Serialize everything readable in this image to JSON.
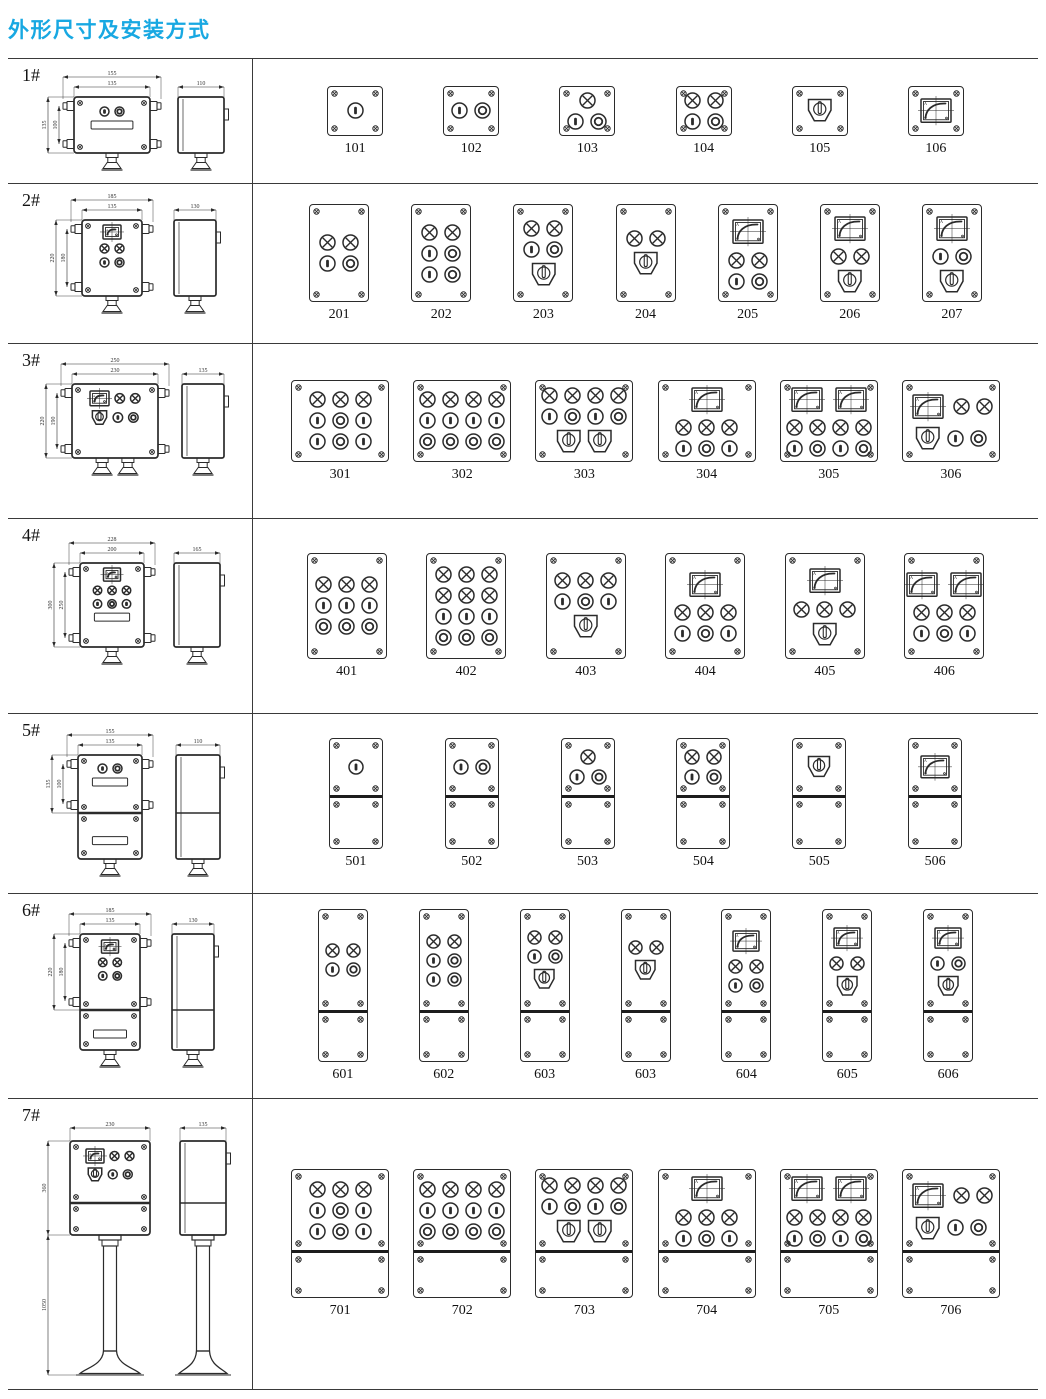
{
  "title": "外形尺寸及安装方式",
  "colors": {
    "accent": "#18a8e2",
    "line": "#2b2b2b"
  },
  "symbols": {
    "meter_label": "A"
  },
  "rows": [
    {
      "label": "1#",
      "dims": {
        "top_outer": "155",
        "top_inner": "135",
        "side_width": "110",
        "height_outer": "135",
        "height_inner": "100"
      },
      "variants": [
        {
          "id": "101",
          "rows": [
            [
              "btn1"
            ]
          ]
        },
        {
          "id": "102",
          "rows": [
            [
              "btn1",
              "btn2"
            ]
          ]
        },
        {
          "id": "103",
          "rows": [
            [
              "lamp"
            ],
            [
              "btn1",
              "btn2"
            ]
          ]
        },
        {
          "id": "104",
          "rows": [
            [
              "lamp",
              "lamp"
            ],
            [
              "btn1",
              "btn2"
            ]
          ]
        },
        {
          "id": "105",
          "rows": [
            [
              "rotary"
            ]
          ]
        },
        {
          "id": "106",
          "rows": [
            [
              "meter"
            ]
          ]
        }
      ]
    },
    {
      "label": "2#",
      "dims": {
        "top_outer": "185",
        "top_inner": "135",
        "side_width": "130",
        "height_outer": "220",
        "height_inner": "180"
      },
      "variants": [
        {
          "id": "201",
          "rows": [
            [
              "lamp",
              "lamp"
            ],
            [
              "btn1",
              "btn2"
            ]
          ]
        },
        {
          "id": "202",
          "rows": [
            [
              "lamp",
              "lamp"
            ],
            [
              "btn1",
              "btn2"
            ],
            [
              "btn1",
              "btn2"
            ]
          ]
        },
        {
          "id": "203",
          "rows": [
            [
              "lamp",
              "lamp"
            ],
            [
              "btn1",
              "btn2"
            ],
            [
              "rotary"
            ]
          ]
        },
        {
          "id": "204",
          "rows": [
            [
              "lamp",
              "lamp"
            ],
            [
              "rotary"
            ]
          ]
        },
        {
          "id": "205",
          "rows": [
            [
              "meter"
            ],
            [
              "lamp",
              "lamp"
            ],
            [
              "btn1",
              "btn2"
            ]
          ]
        },
        {
          "id": "206",
          "rows": [
            [
              "meter"
            ],
            [
              "lamp",
              "lamp"
            ],
            [
              "rotary"
            ]
          ]
        },
        {
          "id": "207",
          "rows": [
            [
              "meter"
            ],
            [
              "btn1",
              "btn2"
            ],
            [
              "rotary"
            ]
          ]
        }
      ]
    },
    {
      "label": "3#",
      "dims": {
        "top_outer": "250",
        "top_inner": "230",
        "side_width": "135",
        "height_outer": "220",
        "height_inner": "190"
      },
      "variants": [
        {
          "id": "301",
          "rows": [
            [
              "lamp",
              "lamp",
              "lamp"
            ],
            [
              "btn1",
              "btn2",
              "btn1"
            ],
            [
              "btn1",
              "btn2",
              "btn1"
            ]
          ]
        },
        {
          "id": "302",
          "rows": [
            [
              "lamp",
              "lamp",
              "lamp",
              "lamp"
            ],
            [
              "btn1",
              "btn1",
              "btn1",
              "btn1"
            ],
            [
              "btn2",
              "btn2",
              "btn2",
              "btn2"
            ]
          ]
        },
        {
          "id": "303",
          "rows": [
            [
              "lamp",
              "lamp",
              "lamp",
              "lamp"
            ],
            [
              "btn1",
              "btn2",
              "btn1",
              "btn2"
            ],
            [
              "rotary",
              "rotary"
            ]
          ]
        },
        {
          "id": "304",
          "rows": [
            [
              "meter"
            ],
            [
              "lamp",
              "lamp",
              "lamp"
            ],
            [
              "btn1",
              "btn2",
              "btn1"
            ]
          ]
        },
        {
          "id": "305",
          "rows": [
            [
              "meter",
              "meter"
            ],
            [
              "lamp",
              "lamp",
              "lamp",
              "lamp"
            ],
            [
              "btn1",
              "btn2",
              "btn1",
              "btn2"
            ]
          ]
        },
        {
          "id": "306",
          "rows": [
            [
              "meter",
              "lamp",
              "lamp"
            ],
            [
              "rotary",
              "btn1",
              "btn2"
            ]
          ]
        }
      ]
    },
    {
      "label": "4#",
      "dims": {
        "top_outer": "228",
        "top_inner": "200",
        "side_width": "165",
        "height_outer": "300",
        "height_inner": "250"
      },
      "variants": [
        {
          "id": "401",
          "rows": [
            [
              "lamp",
              "lamp",
              "lamp"
            ],
            [
              "btn1",
              "btn1",
              "btn1"
            ],
            [
              "btn2",
              "btn2",
              "btn2"
            ]
          ]
        },
        {
          "id": "402",
          "rows": [
            [
              "lamp",
              "lamp",
              "lamp"
            ],
            [
              "lamp",
              "lamp",
              "lamp"
            ],
            [
              "btn1",
              "btn1",
              "btn1"
            ],
            [
              "btn2",
              "btn2",
              "btn2"
            ]
          ]
        },
        {
          "id": "403",
          "rows": [
            [
              "lamp",
              "lamp",
              "lamp"
            ],
            [
              "btn1",
              "btn2",
              "btn1"
            ],
            [
              "rotary"
            ]
          ]
        },
        {
          "id": "404",
          "rows": [
            [
              "meter"
            ],
            [
              "lamp",
              "lamp",
              "lamp"
            ],
            [
              "btn1",
              "btn2",
              "btn1"
            ]
          ]
        },
        {
          "id": "405",
          "rows": [
            [
              "meter"
            ],
            [
              "lamp",
              "lamp",
              "lamp"
            ],
            [
              "rotary"
            ]
          ]
        },
        {
          "id": "406",
          "rows": [
            [
              "meter",
              "meter"
            ],
            [
              "lamp",
              "lamp",
              "lamp"
            ],
            [
              "btn1",
              "btn2",
              "btn1"
            ]
          ]
        }
      ]
    },
    {
      "label": "5#",
      "dims": {
        "top_outer": "155",
        "top_inner": "135",
        "side_width": "110",
        "height_outer": "135",
        "height_inner": "100"
      },
      "variants": [
        {
          "id": "501",
          "rows": [
            [
              "btn1"
            ]
          ]
        },
        {
          "id": "502",
          "rows": [
            [
              "btn1",
              "btn2"
            ]
          ]
        },
        {
          "id": "503",
          "rows": [
            [
              "lamp"
            ],
            [
              "btn1",
              "btn2"
            ]
          ]
        },
        {
          "id": "504",
          "rows": [
            [
              "lamp",
              "lamp"
            ],
            [
              "btn1",
              "btn2"
            ]
          ]
        },
        {
          "id": "505",
          "rows": [
            [
              "rotary"
            ]
          ]
        },
        {
          "id": "506",
          "rows": [
            [
              "meter"
            ]
          ]
        }
      ]
    },
    {
      "label": "6#",
      "dims": {
        "top_outer": "185",
        "top_inner": "135",
        "side_width": "130",
        "height_outer": "220",
        "height_inner": "180"
      },
      "variants": [
        {
          "id": "601",
          "rows": [
            [
              "lamp",
              "lamp"
            ],
            [
              "btn1",
              "btn2"
            ]
          ]
        },
        {
          "id": "602",
          "rows": [
            [
              "lamp",
              "lamp"
            ],
            [
              "btn1",
              "btn2"
            ],
            [
              "btn1",
              "btn2"
            ]
          ]
        },
        {
          "id": "603",
          "rows": [
            [
              "lamp",
              "lamp"
            ],
            [
              "btn1",
              "btn2"
            ],
            [
              "rotary"
            ]
          ]
        },
        {
          "id": "603",
          "rows": [
            [
              "lamp",
              "lamp"
            ],
            [
              "rotary"
            ]
          ]
        },
        {
          "id": "604",
          "rows": [
            [
              "meter"
            ],
            [
              "lamp",
              "lamp"
            ],
            [
              "btn1",
              "btn2"
            ]
          ]
        },
        {
          "id": "605",
          "rows": [
            [
              "meter"
            ],
            [
              "lamp",
              "lamp"
            ],
            [
              "rotary"
            ]
          ]
        },
        {
          "id": "606",
          "rows": [
            [
              "meter"
            ],
            [
              "btn1",
              "btn2"
            ],
            [
              "rotary"
            ]
          ]
        }
      ]
    },
    {
      "label": "7#",
      "dims": {
        "top_outer": "230",
        "side_width": "135",
        "height_outer": "360",
        "height_pole": "1050"
      },
      "variants": [
        {
          "id": "701",
          "rows": [
            [
              "lamp",
              "lamp",
              "lamp"
            ],
            [
              "btn1",
              "btn2",
              "btn1"
            ],
            [
              "btn1",
              "btn2",
              "btn1"
            ]
          ]
        },
        {
          "id": "702",
          "rows": [
            [
              "lamp",
              "lamp",
              "lamp",
              "lamp"
            ],
            [
              "btn1",
              "btn1",
              "btn1",
              "btn1"
            ],
            [
              "btn2",
              "btn2",
              "btn2",
              "btn2"
            ]
          ]
        },
        {
          "id": "703",
          "rows": [
            [
              "lamp",
              "lamp",
              "lamp",
              "lamp"
            ],
            [
              "btn1",
              "btn2",
              "btn1",
              "btn2"
            ],
            [
              "rotary",
              "rotary"
            ]
          ]
        },
        {
          "id": "704",
          "rows": [
            [
              "meter"
            ],
            [
              "lamp",
              "lamp",
              "lamp"
            ],
            [
              "btn1",
              "btn2",
              "btn1"
            ]
          ]
        },
        {
          "id": "705",
          "rows": [
            [
              "meter",
              "meter"
            ],
            [
              "lamp",
              "lamp",
              "lamp",
              "lamp"
            ],
            [
              "btn1",
              "btn2",
              "btn1",
              "btn2"
            ]
          ]
        },
        {
          "id": "706",
          "rows": [
            [
              "meter",
              "lamp",
              "lamp"
            ],
            [
              "rotary",
              "btn1",
              "btn2"
            ]
          ]
        }
      ]
    }
  ]
}
